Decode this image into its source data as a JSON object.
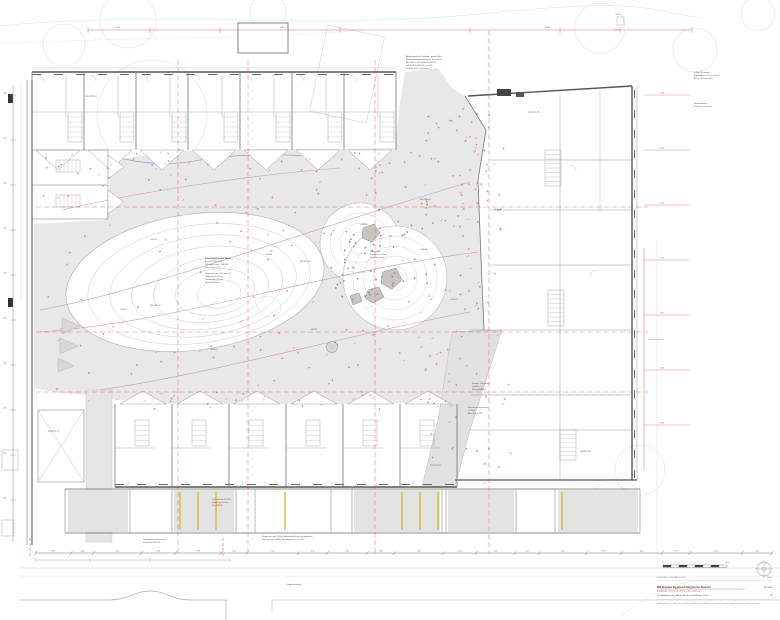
{
  "labels": {
    "haus_a": "HAUS A",
    "haus_b": "HAUS B",
    "haus_c": "HAUS C",
    "haus_d": "HAUS D",
    "haus_e": "HAUS E",
    "boundary": "Grundstücksgrenze",
    "bench": "584.08",
    "bench2": "Bank"
  },
  "annotations": {
    "top_note": [
      "Belagswechsel Ortbeton, geschliffen",
      "Entwässerungsrinne gem. Detail 4.12",
      "Anschluss an Bestand DN 150",
      "OK Belag +584.10 = ±0.00",
      "Gefälle 2.0 % zur Rinne"
    ],
    "top_right_note": [
      "Zufahrt Feuerwehr",
      "Aufstellfläche 3.50 x 11.00 m",
      "Belag: Schotterrasen"
    ],
    "top_right_note2": [
      "Bestandsbaum",
      "erhalten u. schützen"
    ],
    "mound_note": [
      "Rasenhügel große Wiese",
      "Ansaat RSM 7.1.2",
      "OK Hügel max. +585.60",
      "Böschung ≤ 1:3",
      "Unterbau gem. Schnitt C-C",
      "Dränschicht 15 cm",
      "Oberboden 20 cm",
      "Rasen ansäen"
    ],
    "hill_note": [
      "Pflanzhügel",
      "Stauden u. Gräser",
      "Findlinge Granit"
    ],
    "ramp_note": [
      "Rampe Tiefgarage",
      "Gefälle 6 %",
      "Belag Asphalt"
    ],
    "ramp_note2": [
      "Entwässerungsrinne",
      "V-Profil",
      "Anschluss RW"
    ],
    "storage_note": [
      "Fahrradraum 28 StPl.",
      "Wände gestrichen",
      "Tür T30 RS"
    ],
    "bottom_note": [
      "Leitungstrasse Fernwärme",
      "Schutzrohr DN 200"
    ],
    "bottom_note2": [
      "Baugrenze gem. B-Plan, Abstandsflächen nachgewiesen",
      "Höhenbezug: DHHN2016, Angaben in m ü. NN"
    ],
    "street_note": "Eggebrechtweg"
  },
  "spot_elevations": [
    "+584.12",
    "+584.36",
    "+584.55",
    "+585.60",
    "+584.08",
    "+583.95",
    "+584.72",
    "+584.20"
  ],
  "drainage_labels": [
    "RW DN 150",
    "RW DN 200",
    "SW DN 150"
  ],
  "dimensions": {
    "top": [
      "12.45",
      "8.36",
      "24.80"
    ],
    "left": [
      "2.80",
      "3.15",
      "4.20",
      "2.64",
      "3.90",
      "2.45",
      "5.10",
      "3.35",
      "2.90",
      "4.05"
    ],
    "right": [
      "5.48",
      "2.36",
      "4.12",
      "3.75",
      "2.90",
      "4.60",
      "3.25"
    ],
    "bottom": [
      "3.85",
      "2.40",
      "5.12",
      "3.64",
      "4.90",
      "2.75",
      "5.48",
      "3.12",
      "4.26",
      "2.88",
      "5.30",
      "3.45",
      "4.15",
      "2.60",
      "5.05",
      "3.70",
      "4.40",
      "2.95",
      "5.60",
      "3.20"
    ]
  },
  "title_block": {
    "planstand": "PLANSTAND · FREIGABE  04.2019",
    "index_label": "INDEX",
    "scale_values": [
      "0",
      "1",
      "2",
      "5",
      "10 m"
    ],
    "north_label": "N",
    "title1_a": "WB Emmaus Eggebrechtweg Kirche Bestand",
    "title1_b": "Freianlagen Innenhof · Belag u. Ausstattung",
    "title1_c": "M 1:100",
    "title2": "OG  Neubebauung, Belag, Mauern und Bäume  1:100",
    "index_letter": "d",
    "footer": "Maßangaben in m · Höhen in m ü. NN · alle Maße sind vor Ausführung am Bau zu prüfen · Planinhalt urheberrechtlich geschützt"
  }
}
